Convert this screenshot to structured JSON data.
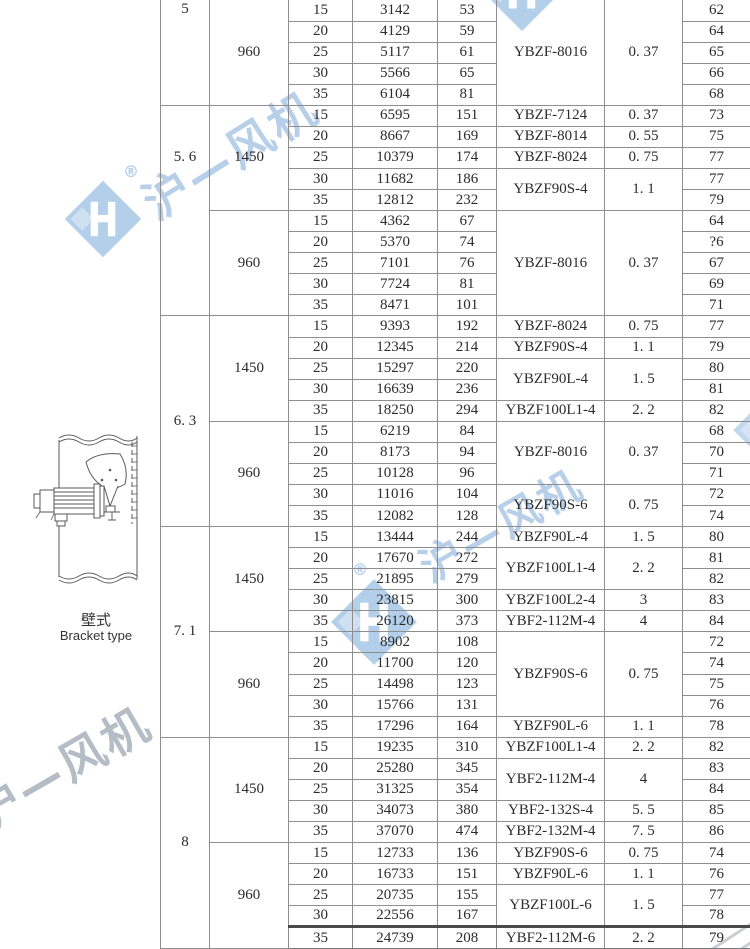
{
  "watermark": {
    "text": "沪—风机",
    "reg": "®",
    "blue": "#b3cfe9",
    "gray_text": "#b4bdc6"
  },
  "diagram": {
    "label_cn": "壁式",
    "label_en": "Bracket type"
  },
  "table": {
    "column_keys": [
      "size",
      "rpm",
      "angle",
      "airflow",
      "pressure",
      "motor_model",
      "power",
      "noise"
    ],
    "sections": [
      {
        "size": "5",
        "blocks": [
          {
            "rpm": "960",
            "rows": [
              {
                "angle": "15",
                "flow": "3142",
                "press": "53",
                "model": {
                  "t": "YBZF-8016",
                  "s": 5
                },
                "power": {
                  "t": "0. 37",
                  "s": 5
                },
                "noise": "62"
              },
              {
                "angle": "20",
                "flow": "4129",
                "press": "59",
                "noise": "64"
              },
              {
                "angle": "25",
                "flow": "5117",
                "press": "61",
                "noise": "65"
              },
              {
                "angle": "30",
                "flow": "5566",
                "press": "65",
                "noise": "66"
              },
              {
                "angle": "35",
                "flow": "6104",
                "press": "81",
                "noise": "68"
              }
            ]
          }
        ]
      },
      {
        "size": "5. 6",
        "blocks": [
          {
            "rpm": "1450",
            "rows": [
              {
                "angle": "15",
                "flow": "6595",
                "press": "151",
                "model": {
                  "t": "YBZF-7124",
                  "s": 1
                },
                "power": {
                  "t": "0. 37",
                  "s": 1
                },
                "noise": "73"
              },
              {
                "angle": "20",
                "flow": "8667",
                "press": "169",
                "model": {
                  "t": "YBZF-8014",
                  "s": 1
                },
                "power": {
                  "t": "0. 55",
                  "s": 1
                },
                "noise": "75"
              },
              {
                "angle": "25",
                "flow": "10379",
                "press": "174",
                "model": {
                  "t": "YBZF-8024",
                  "s": 1
                },
                "power": {
                  "t": "0. 75",
                  "s": 1
                },
                "noise": "77"
              },
              {
                "angle": "30",
                "flow": "11682",
                "press": "186",
                "model": {
                  "t": "YBZF90S-4",
                  "s": 2
                },
                "power": {
                  "t": "1. 1",
                  "s": 2
                },
                "noise": "77"
              },
              {
                "angle": "35",
                "flow": "12812",
                "press": "232",
                "noise": "79"
              }
            ]
          },
          {
            "rpm": "960",
            "rows": [
              {
                "angle": "15",
                "flow": "4362",
                "press": "67",
                "model": {
                  "t": "YBZF-8016",
                  "s": 5
                },
                "power": {
                  "t": "0. 37",
                  "s": 5
                },
                "noise": "64"
              },
              {
                "angle": "20",
                "flow": "5370",
                "press": "74",
                "noise": "?6"
              },
              {
                "angle": "25",
                "flow": "7101",
                "press": "76",
                "noise": "67"
              },
              {
                "angle": "30",
                "flow": "7724",
                "press": "81",
                "noise": "69"
              },
              {
                "angle": "35",
                "flow": "8471",
                "press": "101",
                "noise": "71"
              }
            ]
          }
        ]
      },
      {
        "size": "6. 3",
        "blocks": [
          {
            "rpm": "1450",
            "rows": [
              {
                "angle": "15",
                "flow": "9393",
                "press": "192",
                "model": {
                  "t": "YBZF-8024",
                  "s": 1
                },
                "power": {
                  "t": "0. 75",
                  "s": 1
                },
                "noise": "77"
              },
              {
                "angle": "20",
                "flow": "12345",
                "press": "214",
                "model": {
                  "t": "YBZF90S-4",
                  "s": 1
                },
                "power": {
                  "t": "1. 1",
                  "s": 1
                },
                "noise": "79"
              },
              {
                "angle": "25",
                "flow": "15297",
                "press": "220",
                "model": {
                  "t": "YBZF90L-4",
                  "s": 2
                },
                "power": {
                  "t": "1. 5",
                  "s": 2
                },
                "noise": "80"
              },
              {
                "angle": "30",
                "flow": "16639",
                "press": "236",
                "noise": "81"
              },
              {
                "angle": "35",
                "flow": "18250",
                "press": "294",
                "model": {
                  "t": "YBZF100L1-4",
                  "s": 1
                },
                "power": {
                  "t": "2. 2",
                  "s": 1
                },
                "noise": "82"
              }
            ]
          },
          {
            "rpm": "960",
            "rows": [
              {
                "angle": "15",
                "flow": "6219",
                "press": "84",
                "model": {
                  "t": "YBZF-8016",
                  "s": 3
                },
                "power": {
                  "t": "0. 37",
                  "s": 3
                },
                "noise": "68"
              },
              {
                "angle": "20",
                "flow": "8173",
                "press": "94",
                "noise": "70"
              },
              {
                "angle": "25",
                "flow": "10128",
                "press": "96",
                "noise": "71"
              },
              {
                "angle": "30",
                "flow": "11016",
                "press": "104",
                "model": {
                  "t": "YBZF90S-6",
                  "s": 2
                },
                "power": {
                  "t": "0. 75",
                  "s": 2
                },
                "noise": "72"
              },
              {
                "angle": "35",
                "flow": "12082",
                "press": "128",
                "noise": "74"
              }
            ]
          }
        ]
      },
      {
        "size": "7. 1",
        "blocks": [
          {
            "rpm": "1450",
            "rows": [
              {
                "angle": "15",
                "flow": "13444",
                "press": "244",
                "model": {
                  "t": "YBZF90L-4",
                  "s": 1
                },
                "power": {
                  "t": "1. 5",
                  "s": 1
                },
                "noise": "80"
              },
              {
                "angle": "20",
                "flow": "17670",
                "press": "272",
                "model": {
                  "t": "YBZF100L1-4",
                  "s": 2
                },
                "power": {
                  "t": "2. 2",
                  "s": 2
                },
                "noise": "81"
              },
              {
                "angle": "25",
                "flow": "21895",
                "press": "279",
                "noise": "82"
              },
              {
                "angle": "30",
                "flow": "23815",
                "press": "300",
                "model": {
                  "t": "YBZF100L2-4",
                  "s": 1
                },
                "power": {
                  "t": "3",
                  "s": 1
                },
                "noise": "83"
              },
              {
                "angle": "35",
                "flow": "26120",
                "press": "373",
                "model": {
                  "t": "YBF2-112M-4",
                  "s": 1
                },
                "power": {
                  "t": "4",
                  "s": 1
                },
                "noise": "84"
              }
            ]
          },
          {
            "rpm": "960",
            "rows": [
              {
                "angle": "15",
                "flow": "8902",
                "press": "108",
                "model": {
                  "t": "YBZF90S-6",
                  "s": 4
                },
                "power": {
                  "t": "0. 75",
                  "s": 4
                },
                "noise": "72"
              },
              {
                "angle": "20",
                "flow": "11700",
                "press": "120",
                "noise": "74"
              },
              {
                "angle": "25",
                "flow": "14498",
                "press": "123",
                "noise": "75"
              },
              {
                "angle": "30",
                "flow": "15766",
                "press": "131",
                "noise": "76"
              },
              {
                "angle": "35",
                "flow": "17296",
                "press": "164",
                "model": {
                  "t": "YBZF90L-6",
                  "s": 1
                },
                "power": {
                  "t": "1. 1",
                  "s": 1
                },
                "noise": "78"
              }
            ]
          }
        ]
      },
      {
        "size": "8",
        "blocks": [
          {
            "rpm": "1450",
            "rows": [
              {
                "angle": "15",
                "flow": "19235",
                "press": "310",
                "model": {
                  "t": "YBZF100L1-4",
                  "s": 1
                },
                "power": {
                  "t": "2. 2",
                  "s": 1
                },
                "noise": "82"
              },
              {
                "angle": "20",
                "flow": "25280",
                "press": "345",
                "model": {
                  "t": "YBF2-112M-4",
                  "s": 2
                },
                "power": {
                  "t": "4",
                  "s": 2
                },
                "noise": "83"
              },
              {
                "angle": "25",
                "flow": "31325",
                "press": "354",
                "noise": "84"
              },
              {
                "angle": "30",
                "flow": "34073",
                "press": "380",
                "model": {
                  "t": "YBF2-132S-4",
                  "s": 1
                },
                "power": {
                  "t": "5. 5",
                  "s": 1
                },
                "noise": "85"
              },
              {
                "angle": "35",
                "flow": "37070",
                "press": "474",
                "model": {
                  "t": "YBF2-132M-4",
                  "s": 1
                },
                "power": {
                  "t": "7. 5",
                  "s": 1
                },
                "noise": "86"
              }
            ]
          },
          {
            "rpm": "960",
            "rows": [
              {
                "angle": "15",
                "flow": "12733",
                "press": "136",
                "model": {
                  "t": "YBZF90S-6",
                  "s": 1
                },
                "power": {
                  "t": "0. 75",
                  "s": 1
                },
                "noise": "74"
              },
              {
                "angle": "20",
                "flow": "16733",
                "press": "151",
                "model": {
                  "t": "YBZF90L-6",
                  "s": 1
                },
                "power": {
                  "t": "1. 1",
                  "s": 1
                },
                "noise": "76"
              },
              {
                "angle": "25",
                "flow": "20735",
                "press": "155",
                "model": {
                  "t": "YBZF100L-6",
                  "s": 2
                },
                "power": {
                  "t": "1. 5",
                  "s": 2
                },
                "noise": "77"
              },
              {
                "angle": "30",
                "flow": "22556",
                "press": "167",
                "noise": "78"
              },
              {
                "angle": "35",
                "flow": "24739",
                "press": "208",
                "model": {
                  "t": "YBF2-112M-6",
                  "s": 1
                },
                "power": {
                  "t": "2. 2",
                  "s": 1
                },
                "noise": "79"
              }
            ]
          }
        ]
      }
    ]
  }
}
